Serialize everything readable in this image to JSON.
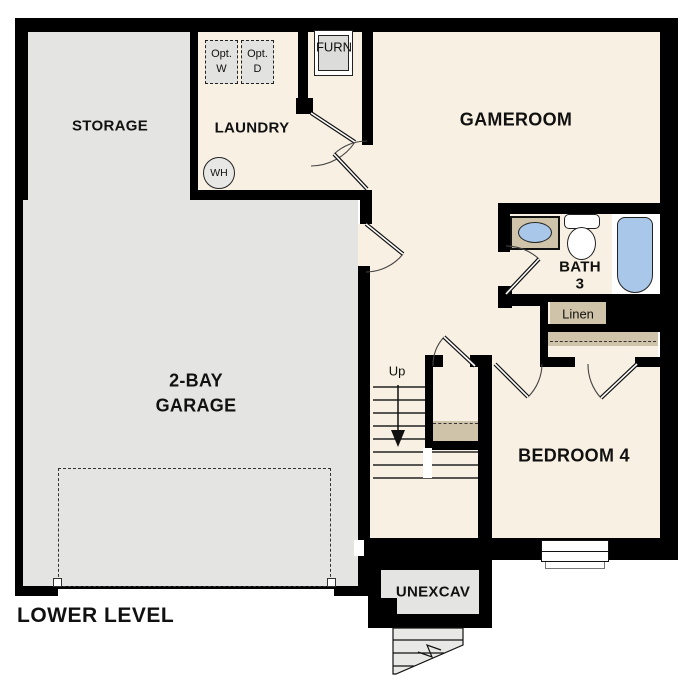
{
  "plan": {
    "title": "LOWER LEVEL",
    "rooms": {
      "storage": "STORAGE",
      "laundry": "LAUNDRY",
      "gameroom": "GAMEROOM",
      "garage_line1": "2-BAY",
      "garage_line2": "GARAGE",
      "bath_line1": "BATH",
      "bath_line2": "3",
      "bedroom": "BEDROOM 4",
      "unexcav": "UNEXCAV",
      "linen": "Linen"
    },
    "fixtures": {
      "opt_washer_line1": "Opt.",
      "opt_washer_line2": "W",
      "opt_dryer_line1": "Opt.",
      "opt_dryer_line2": "D",
      "water_heater": "WH",
      "furnace": "FURN",
      "stairs_up": "Up"
    },
    "colors": {
      "wall": "#000000",
      "floor_cream": "#f8f0e2",
      "floor_gray": "#e4e4e2",
      "casework_tan": "#cfc3a9",
      "fixture_blue": "#a9c7e8",
      "background": "#ffffff"
    }
  }
}
